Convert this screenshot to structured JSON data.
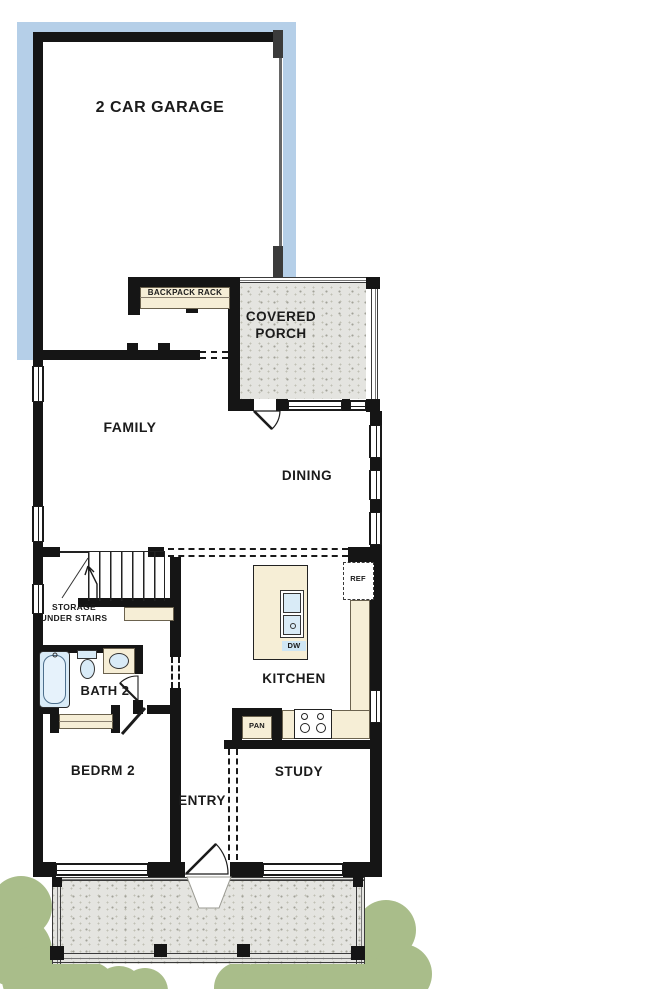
{
  "rooms": {
    "garage": {
      "label": "2 CAR GARAGE"
    },
    "backpack_rack": {
      "label": "BACKPACK RACK"
    },
    "covered_porch": {
      "label": "COVERED PORCH"
    },
    "family": {
      "label": "FAMILY"
    },
    "dining": {
      "label": "DINING"
    },
    "kitchen": {
      "label": "KITCHEN"
    },
    "storage": {
      "label": "STORAGE UNDER STAIRS"
    },
    "bath2": {
      "label": "BATH 2"
    },
    "bedroom2": {
      "label": "BEDRM 2"
    },
    "entry": {
      "label": "ENTRY"
    },
    "study": {
      "label": "STUDY"
    }
  },
  "appliances": {
    "refrigerator": {
      "label": "REF"
    },
    "dishwasher": {
      "label": "DW"
    },
    "pantry": {
      "label": "PAN"
    }
  },
  "colors": {
    "driveway_blue": "#b5cfe8",
    "concrete_gray": "#e4e4e0",
    "casework_beige": "#f6eed6",
    "fixture_blue": "#d9ebf7",
    "landscape_green": "#a9bd8a",
    "wall_black": "#151515"
  }
}
